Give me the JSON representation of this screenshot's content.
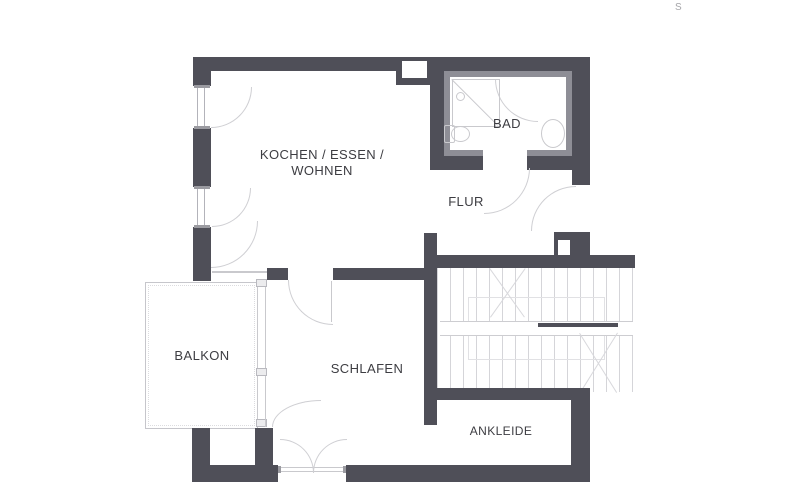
{
  "plan": {
    "watermark": "S",
    "rooms": {
      "kitchen_living": {
        "line1": "KOCHEN / ESSEN /",
        "line2": "WOHNEN"
      },
      "hall": {
        "label": "FLUR"
      },
      "bath": {
        "label": "BAD"
      },
      "bedroom": {
        "label": "SCHLAFEN"
      },
      "balcony": {
        "label": "BALKON"
      },
      "dressing": {
        "label": "ANKLEIDE"
      }
    },
    "colors": {
      "wall": "#4f4f58",
      "bath_wall_lining": "#8e8e96",
      "thin_line": "#c9c9cd",
      "label_text": "#3d3d42",
      "background": "#ffffff"
    }
  }
}
